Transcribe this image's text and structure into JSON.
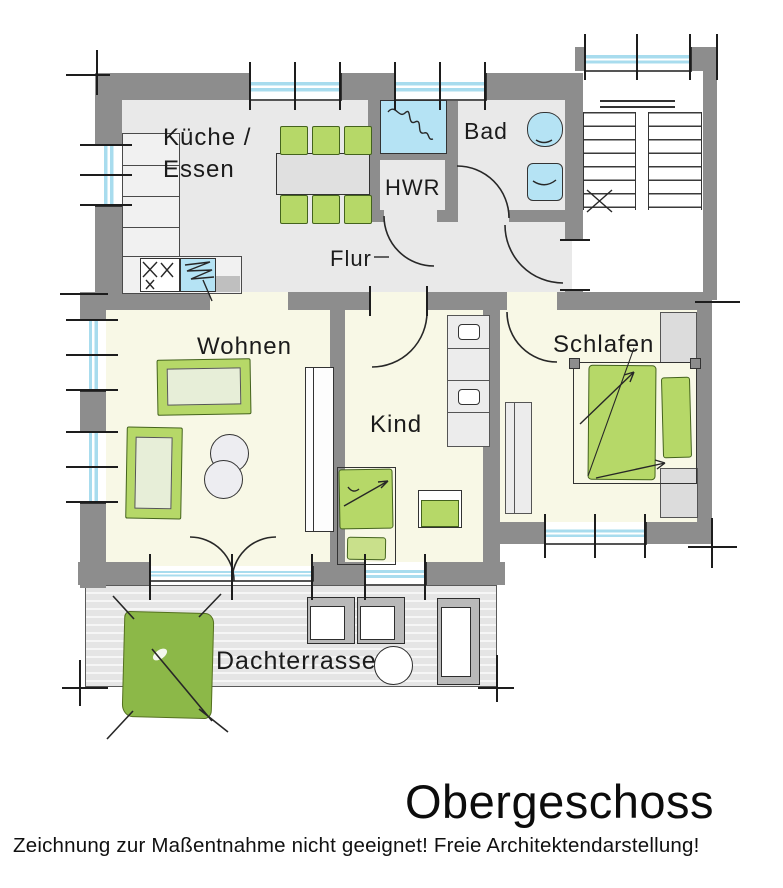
{
  "drawing": {
    "title": "Obergeschoss",
    "disclaimer": "Zeichnung zur Maßentnahme nicht geeignet! Freie Architektendarstellung!"
  },
  "rooms": {
    "kueche_essen": {
      "label": "Küche /\nEssen"
    },
    "hwr": {
      "label": "HWR"
    },
    "bad": {
      "label": "Bad"
    },
    "flur": {
      "label": "Flur"
    },
    "wohnen": {
      "label": "Wohnen"
    },
    "kind": {
      "label": "Kind"
    },
    "schlafen": {
      "label": "Schlafen"
    },
    "dachterrasse": {
      "label": "Dachterrasse"
    }
  },
  "colors": {
    "wall": "#8d8d8d",
    "hard_floor": "#e9e9e9",
    "living_floor": "#f8f8e6",
    "terrace_floor": "#e5e5e5",
    "furniture_green": "#b6d868",
    "awning_green": "#8cb848",
    "fixture_blue": "#b5e3f4",
    "cushion_green": "#e7eed8",
    "line": "#2a2a2a"
  }
}
